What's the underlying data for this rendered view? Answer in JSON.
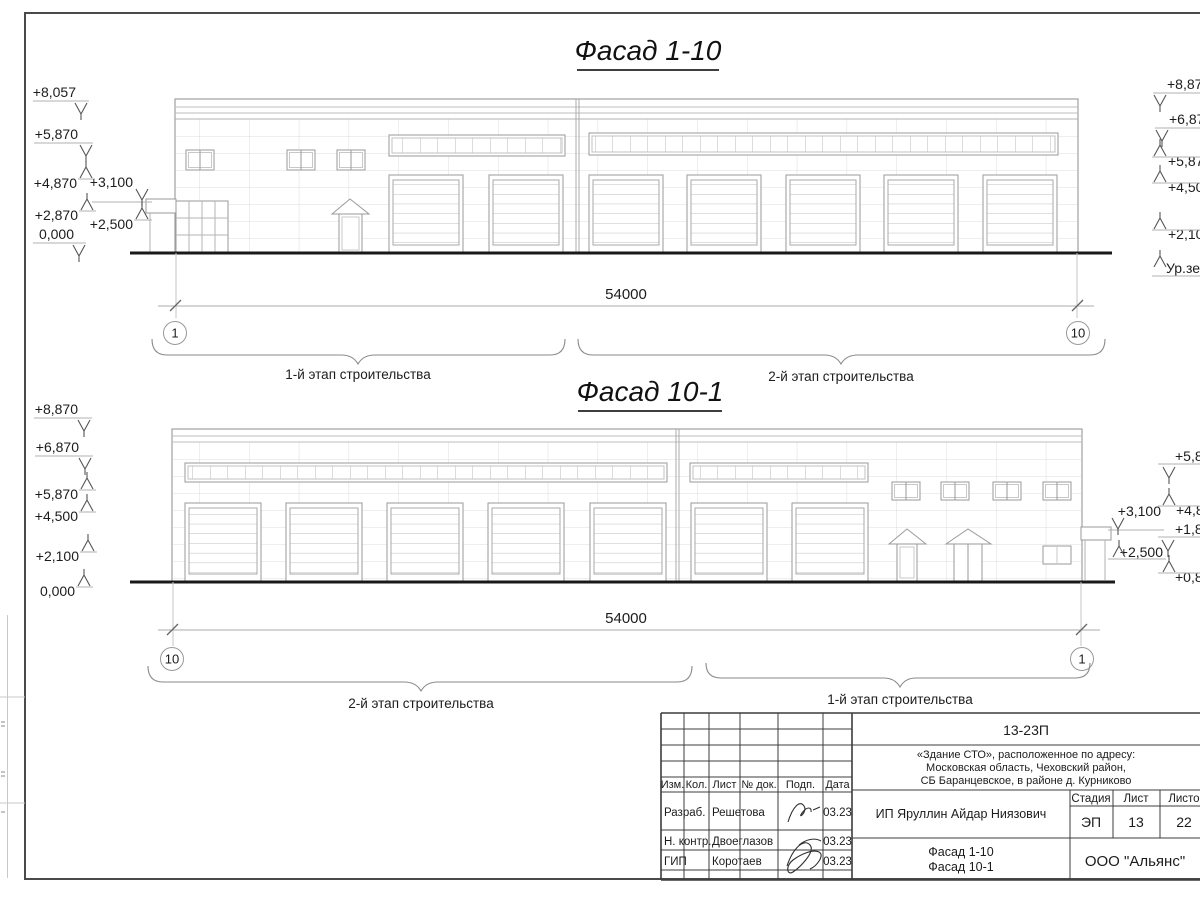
{
  "facade_top": {
    "title": "Фасад 1-10",
    "dimension_total": "54000",
    "axis_left": "1",
    "axis_right": "10",
    "stage_label_left": "1-й этап строительства",
    "stage_label_right": "2-й этап строительства",
    "marks_left": [
      "+8,057",
      "+5,870",
      "+4,870",
      "+3,100",
      "+2,870",
      "+2,500",
      "0,000"
    ],
    "marks_right": [
      "+8,870",
      "+6,870",
      "+5,87",
      "+4,50",
      "+2,10",
      "Ур.зе"
    ]
  },
  "facade_bottom": {
    "title": "Фасад 10-1",
    "dimension_total": "54000",
    "axis_left": "10",
    "axis_right": "1",
    "stage_label_left": "2-й этап строительства",
    "stage_label_right": "1-й этап строительства",
    "marks_left": [
      "+8,870",
      "+6,870",
      "+5,870",
      "+4,500",
      "+2,100",
      "0,000"
    ],
    "marks_right_near": [
      "+3,100",
      "+2,500"
    ],
    "marks_right_edge": [
      "+5,8",
      "+4,8",
      "+1,8",
      "+0,8"
    ]
  },
  "titleblock": {
    "doc_number": "13-23П",
    "address_line1": "«Здание СТО», расположенное по адресу:",
    "address_line2": "Московская область, Чеховский район,",
    "address_line3": "СБ Баранцевское, в районе д. Курниково",
    "client": "ИП Яруллин Айдар Ниязович",
    "sheet_title_line1": "Фасад 1-10",
    "sheet_title_line2": "Фасад 10-1",
    "company": "ООО \"Альянс\"",
    "stage_header": "Стадия",
    "sheet_header": "Лист",
    "sheets_header": "Листов",
    "stage": "ЭП",
    "sheet": "13",
    "sheets": "22",
    "col_izm": "Изм.",
    "col_kol": "Кол.",
    "col_list": "Лист",
    "col_doc": "№ док.",
    "col_podp": "Подп.",
    "col_data": "Дата",
    "rows": [
      {
        "role": "Разраб.",
        "name": "Решетова",
        "date": "03.23"
      },
      {
        "role": "Н. контр.",
        "name": "Двоеглазов",
        "date": "03.23"
      },
      {
        "role": "ГИП",
        "name": "Коротаев",
        "date": "03.23"
      }
    ]
  }
}
